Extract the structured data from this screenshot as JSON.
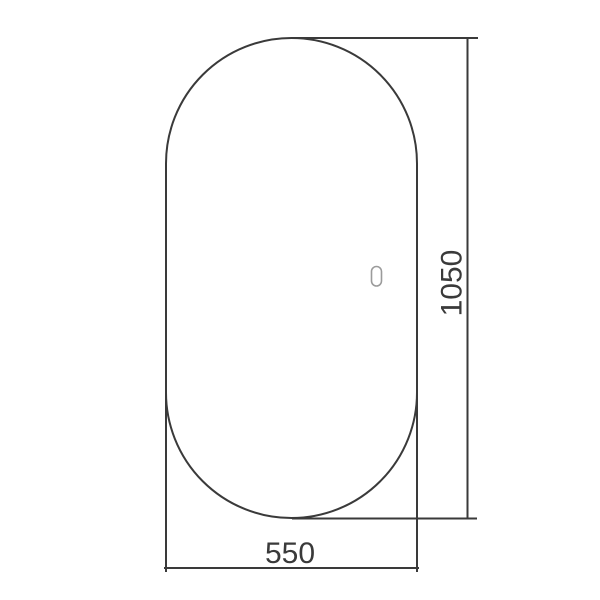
{
  "drawing": {
    "kind": "technical-dimension-drawing",
    "object": "capsule-shaped-mirror-front-view",
    "height_label": "1050",
    "width_label": "550",
    "line_color": "#3a3a3a",
    "text_color": "#3a3a3a",
    "sensor_color": "#9b9b9b",
    "background_color": "#ffffff",
    "icons": {
      "touch_sensor": "touch-sensor-icon"
    }
  }
}
